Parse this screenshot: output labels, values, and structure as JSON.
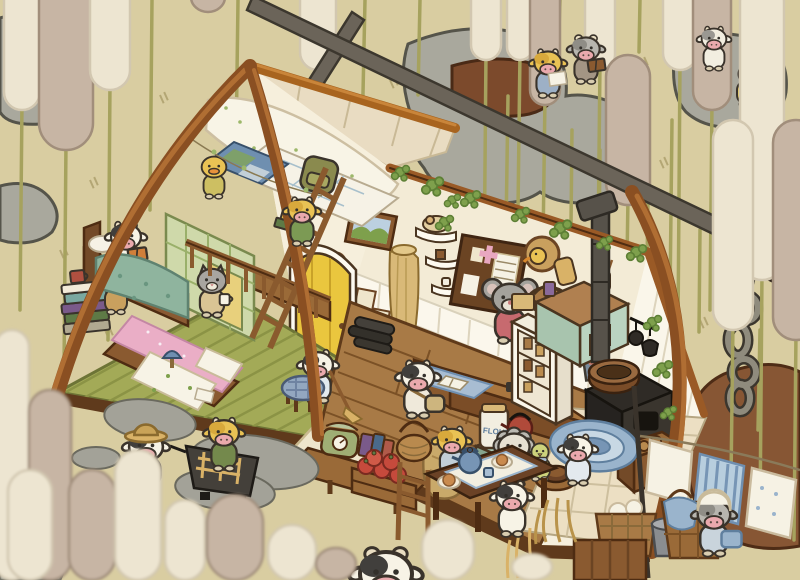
{
  "scene": {
    "description": "Isometric cutaway A-frame cottage of tiny cows among giant cattails: loft bedroom at left, shop counter with mouse shopkeeper in middle, kitchen with iron stove at right, laundry and hay outside",
    "rooms": [
      "bedroom-loft",
      "shop",
      "kitchen"
    ],
    "time": "day"
  },
  "labels": {
    "flour_jar": "FLOUR"
  },
  "palette": {
    "bg": "#d9cda1",
    "hatch": "#b3a674",
    "rock": "#a9a89d",
    "rock_dark": "#55544a",
    "mud": "#7c4a2c",
    "mound": "#875634",
    "beam_dark": "#6b6459",
    "beam_outline": "#3c372e",
    "chain": "#8f8b7d",
    "cattail_cream": "#ede5d1",
    "cattail_cream_line": "#d2c7b0",
    "cattail_taupe": "#c7b5a4",
    "cattail_taupe_line": "#a18e7b",
    "stem": "#a6a25e",
    "wood": "#8a4f22",
    "wood_light": "#b06e33",
    "wood_line": "#4e2c12",
    "wall": "#f6efdc",
    "wall2": "#f3ebd6",
    "plank": "#fbf7ec",
    "plank_line": "#ddd4bd",
    "floor_green": "#a3aa57",
    "floor_green_dark": "#8b9345",
    "floor_wood": "#a87a46",
    "floor_wood_line": "#7b5126",
    "tile": "#ecdfc3",
    "tile_line": "#cdbf9e",
    "door": "#eac63e",
    "counter_top": "#a9763f",
    "counter_front": "#7b4d27",
    "teal": "#bad3c0",
    "blue_cloth": "#a8bdd2",
    "blue_deep": "#6f8fb0",
    "quilt": "#8fb49e",
    "pink": "#eaaec6",
    "ivy": "#7ea04c",
    "ivy_dark": "#5d7f35",
    "iron": "#3a352e",
    "outline": "#4a3520"
  },
  "background": {
    "cattails_far": [
      {
        "x": 22,
        "y": -50,
        "w": 36,
        "h": 160,
        "stem": 200,
        "tone": "cream"
      },
      {
        "x": 66,
        "y": -40,
        "w": 54,
        "h": 190,
        "stem": 220,
        "tone": "taupe"
      },
      {
        "x": 110,
        "y": -70,
        "w": 40,
        "h": 160,
        "stem": 250,
        "tone": "cream"
      },
      {
        "x": 208,
        "y": -18,
        "w": 34,
        "h": 30,
        "stem": 0,
        "tone": "taupe"
      },
      {
        "x": 318,
        "y": -80,
        "w": 36,
        "h": 150,
        "stem": 160,
        "tone": "cream"
      },
      {
        "x": 486,
        "y": -60,
        "w": 30,
        "h": 120,
        "stem": 220,
        "tone": "cream"
      },
      {
        "x": 520,
        "y": -30,
        "w": 26,
        "h": 90,
        "stem": 150,
        "tone": "cream"
      },
      {
        "x": 545,
        "y": -15,
        "w": 30,
        "h": 120,
        "stem": 140,
        "tone": "taupe"
      },
      {
        "x": 600,
        "y": -40,
        "w": 30,
        "h": 110,
        "stem": 180,
        "tone": "cream"
      },
      {
        "x": 628,
        "y": 55,
        "w": 44,
        "h": 150,
        "stem": 120,
        "tone": "taupe"
      },
      {
        "x": 680,
        "y": -50,
        "w": 34,
        "h": 120,
        "stem": 260,
        "tone": "cream"
      },
      {
        "x": 712,
        "y": -30,
        "w": 38,
        "h": 140,
        "stem": 200,
        "tone": "taupe"
      }
    ],
    "cattails_near": [
      {
        "x": 762,
        "y": -20,
        "w": 44,
        "h": 300,
        "stem": 240,
        "tone": "cream"
      },
      {
        "x": 796,
        "y": 120,
        "w": 46,
        "h": 220,
        "stem": 200,
        "tone": "taupe"
      },
      {
        "x": 733,
        "y": 120,
        "w": 40,
        "h": 210,
        "stem": 150,
        "tone": "cream"
      }
    ],
    "cattails_front": [
      {
        "x": 12,
        "y": 330,
        "w": 34,
        "h": 250,
        "tone": "cream"
      },
      {
        "x": 50,
        "y": 390,
        "w": 42,
        "h": 190,
        "tone": "taupe"
      },
      {
        "x": 30,
        "y": 470,
        "w": 44,
        "h": 110,
        "tone": "cream"
      },
      {
        "x": 92,
        "y": 470,
        "w": 46,
        "h": 110,
        "tone": "taupe"
      },
      {
        "x": 138,
        "y": 450,
        "w": 46,
        "h": 130,
        "tone": "cream"
      },
      {
        "x": 185,
        "y": 500,
        "w": 40,
        "h": 80,
        "tone": "cream"
      },
      {
        "x": 235,
        "y": 495,
        "w": 56,
        "h": 85,
        "tone": "taupe"
      },
      {
        "x": 292,
        "y": 525,
        "w": 48,
        "h": 55,
        "tone": "cream"
      },
      {
        "x": 336,
        "y": 548,
        "w": 40,
        "h": 32,
        "tone": "taupe"
      },
      {
        "x": 448,
        "y": 520,
        "w": 52,
        "h": 60,
        "tone": "cream"
      },
      {
        "x": 532,
        "y": 554,
        "w": 40,
        "h": 26,
        "tone": "cream"
      }
    ],
    "stems": [
      [
        152,
        0,
        150,
        210
      ],
      [
        238,
        0,
        236,
        150
      ],
      [
        365,
        0,
        362,
        140
      ],
      [
        420,
        0,
        418,
        95
      ],
      [
        508,
        96,
        505,
        300
      ],
      [
        572,
        130,
        570,
        320
      ],
      [
        600,
        150,
        598,
        330
      ],
      [
        648,
        200,
        646,
        330
      ],
      [
        672,
        120,
        670,
        300
      ],
      [
        700,
        230,
        699,
        332
      ],
      [
        560,
        0,
        558,
        58
      ],
      [
        640,
        0,
        639,
        52
      ],
      [
        760,
        330,
        758,
        430
      ]
    ],
    "hatches": [
      [
        90,
        180
      ],
      [
        160,
        95
      ],
      [
        300,
        45
      ],
      [
        390,
        80
      ],
      [
        440,
        215
      ],
      [
        520,
        150
      ],
      [
        610,
        95
      ],
      [
        660,
        160
      ],
      [
        700,
        320
      ],
      [
        762,
        150
      ],
      [
        60,
        250
      ],
      [
        350,
        120
      ],
      [
        580,
        330
      ],
      [
        170,
        360
      ],
      [
        640,
        60
      ],
      [
        726,
        470
      ],
      [
        105,
        330
      ],
      [
        470,
        40
      ]
    ],
    "ivy": [
      {
        "x": 400,
        "y": 172,
        "s": 1
      },
      {
        "x": 432,
        "y": 185,
        "s": 1.2
      },
      {
        "x": 452,
        "y": 200,
        "s": 0.9
      },
      {
        "x": 444,
        "y": 222,
        "s": 1.0
      },
      {
        "x": 470,
        "y": 198,
        "s": 1.1
      },
      {
        "x": 520,
        "y": 214,
        "s": 1.0
      },
      {
        "x": 560,
        "y": 228,
        "s": 1.2
      },
      {
        "x": 604,
        "y": 242,
        "s": 0.9
      },
      {
        "x": 636,
        "y": 252,
        "s": 1.1
      },
      {
        "x": 652,
        "y": 322,
        "s": 1.0
      },
      {
        "x": 662,
        "y": 368,
        "s": 1.1
      },
      {
        "x": 668,
        "y": 412,
        "s": 0.9
      }
    ]
  },
  "characters": [
    {
      "name": "farmer-cow",
      "kind": "cow",
      "layer": "front",
      "x": 146,
      "y": 448,
      "s": 1.3,
      "body": "#f7f3e6",
      "patch": "#413f3c",
      "outfit": "#6679a0",
      "hat": "straw"
    },
    {
      "name": "jacket-cow",
      "kind": "cow",
      "layer": "front",
      "x": 224,
      "y": 434,
      "s": 1.15,
      "body": "#e9c254",
      "patch": "#d8a93c",
      "outfit": "#74894c"
    },
    {
      "name": "reading-cow-yellow",
      "kind": "cow",
      "layer": "top",
      "x": 548,
      "y": 64,
      "s": 1.05,
      "body": "#e9c254",
      "patch": "#d8a93c",
      "outfit": "#9db0c6",
      "prop": {
        "type": "paper",
        "color": "#f6f2e4"
      }
    },
    {
      "name": "reading-cow-gray",
      "kind": "cow",
      "layer": "top",
      "x": 586,
      "y": 50,
      "s": 1.05,
      "body": "#b7b5ae",
      "patch": "#8f8d86",
      "outfit": "#a39584",
      "horns": true,
      "prop": {
        "type": "book",
        "color": "#8a5a30"
      }
    },
    {
      "name": "rock-cow",
      "kind": "cow",
      "layer": "top",
      "x": 714,
      "y": 40,
      "s": 0.95,
      "body": "#f2eee0",
      "patch": "#9a9892"
    },
    {
      "name": "scarf-chick",
      "kind": "chick",
      "layer": "top",
      "x": 748,
      "y": 74,
      "s": 1.0,
      "body": "#e5c85c",
      "scarf": "#74894c"
    },
    {
      "name": "loft-duck",
      "kind": "duck",
      "layer": "back",
      "x": 214,
      "y": 168,
      "s": 0.95,
      "body": "#e9c254",
      "outfit": "#cdbf62"
    },
    {
      "name": "ladder-cow",
      "kind": "cow",
      "layer": "front",
      "x": 302,
      "y": 212,
      "s": 1.05,
      "body": "#e9c254",
      "patch": "#d8a93c",
      "outfit": "#7c9a54"
    },
    {
      "name": "bed-cow",
      "kind": "cow",
      "layer": "back",
      "x": 126,
      "y": 238,
      "s": 1.15,
      "body": "#f7f3e6",
      "patch": "#413f3c",
      "outfit": "#f7f3e6",
      "prop": {
        "type": "book",
        "color": "#d07f3a"
      }
    },
    {
      "name": "tabby-cat",
      "kind": "cat",
      "layer": "back",
      "x": 116,
      "y": 282,
      "s": 1.0,
      "body": "#d8b277",
      "outfit": "#c9a05e",
      "stripes": true
    },
    {
      "name": "gray-cat",
      "kind": "cat",
      "layer": "back",
      "x": 212,
      "y": 282,
      "s": 1.1,
      "body": "#a8a5a0",
      "outfit": "#d9c494",
      "prop": {
        "type": "mug",
        "color": "#f6f2e4"
      }
    },
    {
      "name": "broom-cow",
      "kind": "cow",
      "layer": "back",
      "x": 318,
      "y": 366,
      "s": 1.15,
      "body": "#f7f3e6",
      "patch": "#413f3c",
      "outfit": "#e3e9ee",
      "prop": {
        "type": "broom",
        "color": "#8a5a2e"
      }
    },
    {
      "name": "satchel-cow",
      "kind": "cow",
      "layer": "front",
      "x": 418,
      "y": 378,
      "s": 1.25,
      "body": "#f7f3e6",
      "patch": "#413f3c",
      "outfit": "#efe9da",
      "satchel": "#cdb57e"
    },
    {
      "name": "mouse-shopkeeper",
      "kind": "mouse",
      "layer": "back",
      "x": 510,
      "y": 300,
      "s": 1.35,
      "body": "#a4a29c",
      "outfit": "#c76a6f"
    },
    {
      "name": "cook-cow",
      "kind": "cow",
      "layer": "front",
      "x": 578,
      "y": 450,
      "s": 1.1,
      "body": "#f7f3e6",
      "patch": "#413f3c",
      "outfit": "#e3e9ee"
    },
    {
      "name": "diner-cow-yellow",
      "kind": "cow",
      "layer": "dining",
      "x": 452,
      "y": 442,
      "s": 1.1,
      "body": "#e9c254",
      "patch": "#d8a93c",
      "outfit": "#c2cfd8"
    },
    {
      "name": "diner-sheep",
      "kind": "sheep",
      "layer": "dining",
      "x": 514,
      "y": 448,
      "s": 1.2,
      "body": "#bab8b1",
      "outfit": "#74894c"
    },
    {
      "name": "chair-chick",
      "kind": "chick",
      "layer": "dining",
      "x": 540,
      "y": 452,
      "s": 0.9,
      "body": "#cdd27c",
      "scarf": "#a8bdd2"
    },
    {
      "name": "diner-cow-bw",
      "kind": "cow",
      "layer": "front",
      "x": 512,
      "y": 498,
      "s": 1.2,
      "body": "#f7f3e6",
      "patch": "#413f3c",
      "outfit": "#f7f3e6"
    },
    {
      "name": "laundry-cow",
      "kind": "cow",
      "layer": "front",
      "x": 714,
      "y": 516,
      "s": 1.25,
      "body": "#b7b5ae",
      "patch": "#8f8d86",
      "outfit": "#c9d4dc",
      "hat": "bonnet",
      "prop": {
        "type": "cloth",
        "color": "#9ab4cc"
      }
    },
    {
      "name": "peeking-cow",
      "kind": "cow",
      "layer": "peek",
      "x": 386,
      "y": 576,
      "s": 2.0,
      "body": "#f7f3e6",
      "patch": "#413f3c",
      "headOnly": true,
      "horns": true
    }
  ]
}
